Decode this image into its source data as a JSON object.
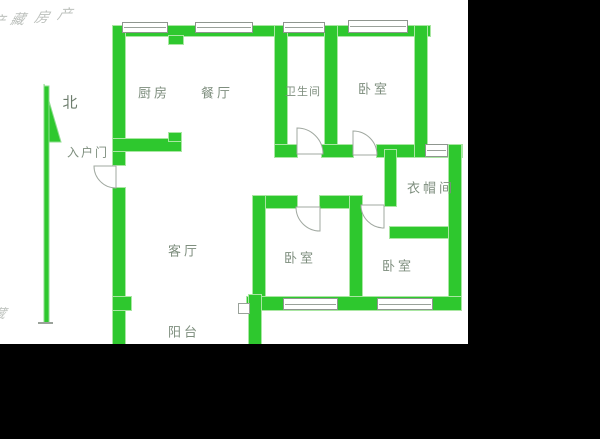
{
  "watermark": {
    "brand": "藏房产",
    "chars": [
      "藏",
      "房",
      "产"
    ],
    "partial_bottom": "藏"
  },
  "compass": {
    "label": "北"
  },
  "rooms": [
    {
      "id": "kitchen",
      "label": "厨房"
    },
    {
      "id": "dining",
      "label": "餐厅"
    },
    {
      "id": "bathroom",
      "label": "卫生间"
    },
    {
      "id": "bedroom-top",
      "label": "卧室"
    },
    {
      "id": "entrance-door",
      "label": "入户门"
    },
    {
      "id": "cloakroom",
      "label": "衣帽间"
    },
    {
      "id": "living-room",
      "label": "客厅"
    },
    {
      "id": "bedroom-left",
      "label": "卧室"
    },
    {
      "id": "bedroom-right",
      "label": "卧室"
    },
    {
      "id": "balcony",
      "label": "阳台"
    }
  ],
  "colors": {
    "wall_green": "#2ec82e",
    "label_gray": "#7e8e7e",
    "background_black": "#000000",
    "plan_white": "#ffffff",
    "watermark_gray": "#bcc0bc"
  }
}
